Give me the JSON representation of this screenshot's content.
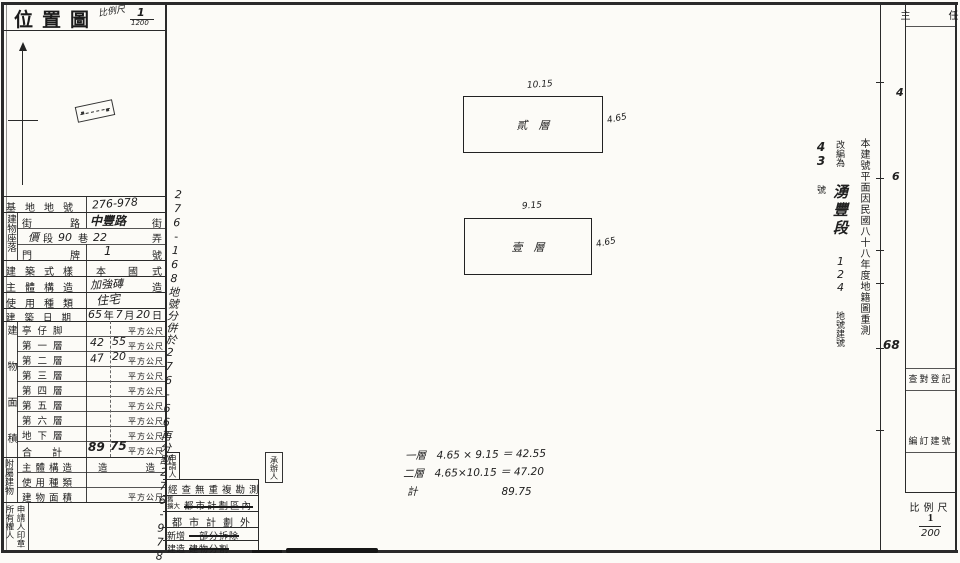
{
  "colors": {
    "ink": "#1b1b1b",
    "paper": "#fcfbf7"
  },
  "title_block": {
    "title": "位置圖",
    "scale_label": "比例尺",
    "scale_num": "1",
    "scale_den": "1200"
  },
  "left_table": {
    "site_no_label": "基地地號",
    "site_no_value": "276-978",
    "location_group": "建物座落",
    "street_label": "街　路",
    "street_value": "中豐路",
    "street_unit": "街",
    "lane_fill": {
      "p1": "價",
      "seg": "段",
      "n1": "90",
      "lane": "巷",
      "n2": "22",
      "alley": "弄"
    },
    "door_label": "門　牌",
    "door_value": "1",
    "door_unit": "號",
    "style_label": "建築式樣",
    "style_value": "本　國",
    "style_unit": "式",
    "structure_label": "主體構造",
    "structure_value": "加強磚",
    "structure_unit": "造",
    "usage_label": "使用種類",
    "usage_value": "住宅",
    "date_label": "建築日期",
    "date": {
      "y": "65",
      "y_u": "年",
      "m": "7",
      "m_u": "月",
      "d": "20",
      "d_u": "日"
    },
    "area_group": "建物面積",
    "floors": [
      {
        "label": "亭仔脚",
        "v1": "",
        "v2": "",
        "unit": "平方公尺"
      },
      {
        "label": "第一層",
        "v1": "42",
        "v2": "55",
        "unit": "平方公尺"
      },
      {
        "label": "第二層",
        "v1": "47",
        "v2": "20",
        "unit": "平方公尺"
      },
      {
        "label": "第三層",
        "v1": "",
        "v2": "",
        "unit": "平方公尺"
      },
      {
        "label": "第四層",
        "v1": "",
        "v2": "",
        "unit": "平方公尺"
      },
      {
        "label": "第五層",
        "v1": "",
        "v2": "",
        "unit": "平方公尺"
      },
      {
        "label": "第六層",
        "v1": "",
        "v2": "",
        "unit": "平方公尺"
      },
      {
        "label": "地下層",
        "v1": "",
        "v2": "",
        "unit": "平方公尺"
      }
    ],
    "total_label": "合　計",
    "total_v1": "89",
    "total_v2": "75",
    "total_unit": "平方公尺",
    "annex_group": "附屬建物",
    "annex_structure_label": "主體構造",
    "annex_structure_value": "造　　　　造",
    "annex_usage_label": "使用種類",
    "annex_area_label": "建物面積",
    "annex_area_unit": "平方公尺",
    "seal_col_right": "申請人印章",
    "seal_col_left": "所有權人"
  },
  "map_area": {
    "parcel_note": "276-168地號分併於276-66再分割276-978地號",
    "buildings": [
      {
        "floor_label": "貳　層",
        "top_dim": "10.15",
        "side_dim": "4.65"
      },
      {
        "floor_label": "壹　層",
        "top_dim": "9.15",
        "side_dim": "4.65"
      }
    ],
    "calc_lines": [
      "一層　4.65 × 9.15 ＝ 42.55",
      "二層　4.65×10.15 ＝ 47.20",
      "計　　　　　　　　89.75"
    ],
    "resurvey_stamp": {
      "col_right": "本建號平面因民國八十八年度地籍圖重測",
      "prefix": "改編為",
      "section": "湧豐段",
      "num1": "124",
      "label1": "地號建號",
      "num2": "43",
      "label2": "號"
    },
    "check_table": {
      "applicant_box": "申請人",
      "handler_box": "承辦人",
      "row1": "經查無重複勘測",
      "row2_left_top": "舊",
      "row2_left_bottom": "擴大",
      "row2_struck": "都市計劃區內",
      "row3": "都市計劃外",
      "row4_label": "新增",
      "row4_struck": "一部分拆除",
      "row5_label": "建造",
      "row5_struck": "建物分割"
    }
  },
  "right_panel": {
    "header": "主　任",
    "review_box": "查對登記",
    "assign_box": "編訂建號",
    "scale_label": "比例尺",
    "scale_num": "1",
    "scale_den": "200",
    "fold_marks": {
      "m1": "4",
      "m2": "6",
      "m3": "68"
    }
  }
}
